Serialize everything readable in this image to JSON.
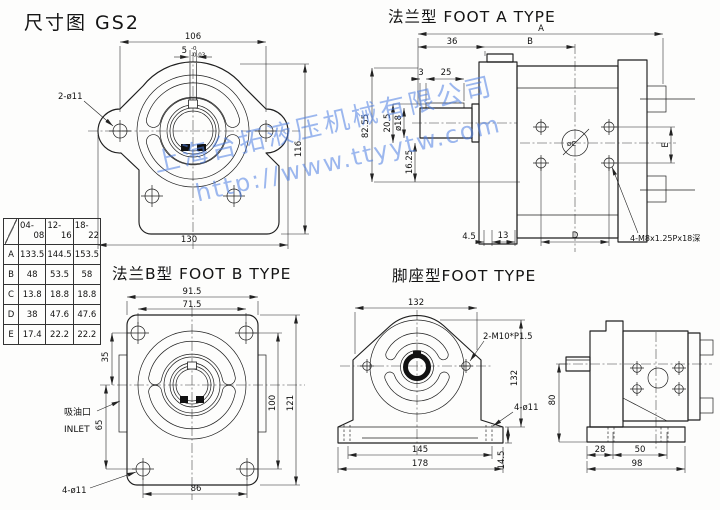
{
  "page": {
    "title": "尺寸图 GS2"
  },
  "watermark": {
    "line1": "上海台拓液压机械有限公司",
    "line2": "http://www.ttyytw.com",
    "color": "#4d7fe3"
  },
  "front_view": {
    "dim_106": "106",
    "key_width": "5",
    "key_tol_upper": "-0",
    "key_tol_lower": "-0.03",
    "dim_116": "116",
    "dim_130": "130",
    "holes_label": "2-ø11"
  },
  "foot_a_view": {
    "title": "法兰型 FOOT A TYPE",
    "dim_A": "A",
    "dim_36": "36",
    "dim_B": "B",
    "dim_3": "3",
    "dim_25": "25",
    "dim_82_55": "82.55",
    "dim_20_5": "20.5",
    "shaft_dia": "ø18",
    "dim_16_25": "16.25",
    "dim_4_5": "4.5",
    "dim_13": "13",
    "dim_D": "D",
    "dim_E": "E",
    "center_label": "øC",
    "thread_label": "4-M8x1.25Px18深"
  },
  "foot_b_view": {
    "title": "法兰B型 FOOT B TYPE",
    "dim_91_5": "91.5",
    "dim_71_5": "71.5",
    "dim_35": "35",
    "dim_65": "65",
    "dim_100": "100",
    "dim_121": "121",
    "dim_86": "86",
    "holes_label": "4-ø11",
    "inlet_cn": "吸油口",
    "inlet_en": "INLET"
  },
  "foot_view": {
    "title": "脚座型FOOT TYPE",
    "dim_132_top": "132",
    "thread_label": "2-M10*P1.5",
    "dim_132_right": "132",
    "holes_label": "4-ø11",
    "dim_14_5": "14.5",
    "dim_145": "145",
    "dim_178": "178"
  },
  "side_view": {
    "dim_80": "80",
    "dim_28": "28",
    "dim_50": "50",
    "dim_98": "98"
  },
  "table": {
    "col_headers": [
      {
        "l1": "04-",
        "l2": "08"
      },
      {
        "l1": "12-",
        "l2": "16"
      },
      {
        "l1": "18-",
        "l2": "22"
      }
    ],
    "rows": [
      {
        "label": "A",
        "v": [
          "133.5",
          "144.5",
          "153.5"
        ]
      },
      {
        "label": "B",
        "v": [
          "48",
          "53.5",
          "58"
        ]
      },
      {
        "label": "C",
        "v": [
          "13.8",
          "18.8",
          "18.8"
        ]
      },
      {
        "label": "D",
        "v": [
          "38",
          "47.6",
          "47.6"
        ]
      },
      {
        "label": "E",
        "v": [
          "17.4",
          "22.2",
          "22.2"
        ]
      }
    ]
  }
}
